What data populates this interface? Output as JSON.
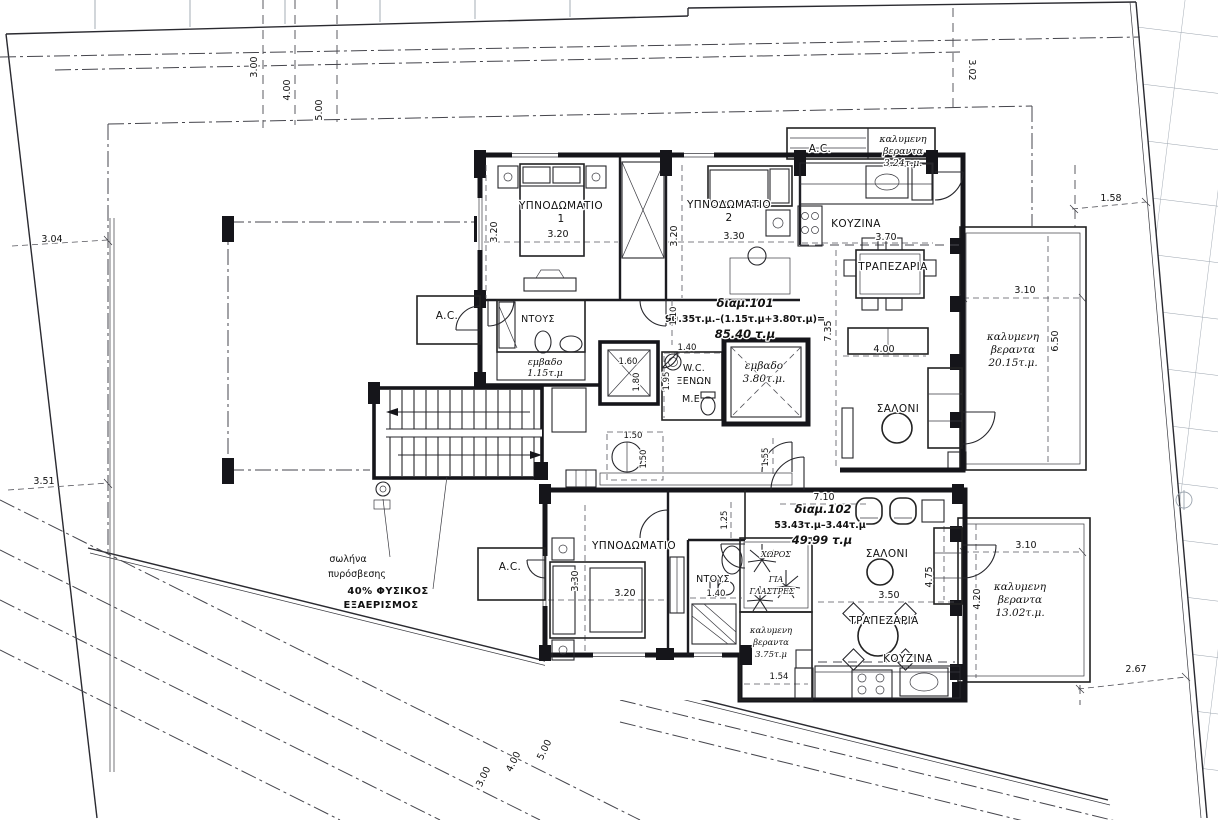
{
  "site": {
    "setback_top": [
      "3.00",
      "4.00",
      "5.00"
    ],
    "setback_bottom": [
      "3.00",
      "4.00",
      "5.00"
    ],
    "boundary_left": [
      "3.04",
      "3.51"
    ],
    "boundary_right_top": "3.02",
    "boundary_right": "1.58",
    "boundary_right_bottom": "2.67",
    "fire_pipe": [
      "σωλήνα",
      "πυρόσβεσης"
    ],
    "ventilation": [
      "40% ΦΥΣΙΚΟΣ",
      "ΕΞΑΕΡΙΣΜΟΣ"
    ]
  },
  "apt101": {
    "id": "διαμ.101",
    "area_formula": "90.35τ.μ.–(1.15τ.μ+3.80τ.μ)=",
    "area_total": "85.40 τ.μ",
    "bedroom1": {
      "name": "ΥΠΝΟΔΩΜΑΤΙΟ",
      "number": "1",
      "width": "3.20",
      "depth": "3.20"
    },
    "bedroom2": {
      "name": "ΥΠΝΟΔΩΜΑΤΙΟ",
      "number": "2",
      "width": "3.30",
      "depth": "3.20"
    },
    "kitchen": {
      "name": "ΚΟΥΖΙΝΑ",
      "width": "3.70"
    },
    "dining": {
      "name": "ΤΡΑΠΕΖΑΡΙΑ"
    },
    "living": {
      "name": "ΣΑΛΟΝΙ",
      "width": "4.00",
      "depth": "7.35"
    },
    "shower": {
      "name": "ΝΤΟΥΣ",
      "area": [
        "εμβαδο",
        "1.15τ.μ"
      ]
    },
    "wc_guest": [
      "W.C.",
      "ΞΕΝΩΝ"
    ],
    "me": "M.E",
    "ac_roof": "A.C.",
    "ac_side": "A.C.",
    "shaft_area": [
      "εμβαδο",
      "3.80τ.μ."
    ],
    "veranda_top": [
      "καλυμενη",
      "βεραντα",
      "3.24τ.μ."
    ],
    "veranda_side": [
      "καλυμενη",
      "βεραντα",
      "20.15τ.μ."
    ],
    "veranda_side_width": "3.10",
    "veranda_side_depth": "6.50",
    "lift_width": "1.60",
    "lift_depth": "1.80",
    "dim_hall": "1.10",
    "dim_wc_width": "1.40",
    "dim_wc_depth": "1.95",
    "dim_entry": "1.55",
    "dim_turn_w": "1.50",
    "dim_turn_h": "1.50"
  },
  "apt102": {
    "id": "διαμ.102",
    "area_formula": "53.43τ.μ–3.44τ.μ",
    "area_total": "49.99 τ.μ",
    "width": "7.10",
    "bedroom": {
      "name": "ΥΠΝΟΔΩΜΑΤΙΟ",
      "width": "3.20",
      "depth": "3.30"
    },
    "shower": {
      "name": "ΝΤΟΥΣ",
      "width": "1.40"
    },
    "living": {
      "name": "ΣΑΛΟΝΙ",
      "depth": "4.75"
    },
    "dining": {
      "name": "ΤΡΑΠΕΖΑΡΙΑ",
      "width": "3.50"
    },
    "kitchen": {
      "name": "ΚΟΥΖΙΝΑ"
    },
    "ac_side": "A.C.",
    "planter": [
      "ΧΩΡΟΣ",
      "ΓΙΑ",
      "ΓΛΑΣΤΡΕΣ"
    ],
    "veranda_small": [
      "καλυμενη",
      "βεραντα",
      "3.75τ.μ"
    ],
    "veranda_small_width": "1.54",
    "veranda_side": [
      "καλυμενη",
      "βεραντα",
      "13.02τ.μ."
    ],
    "veranda_side_width": "3.10",
    "veranda_side_depth": "4.20",
    "dim_hall": "1.25"
  }
}
